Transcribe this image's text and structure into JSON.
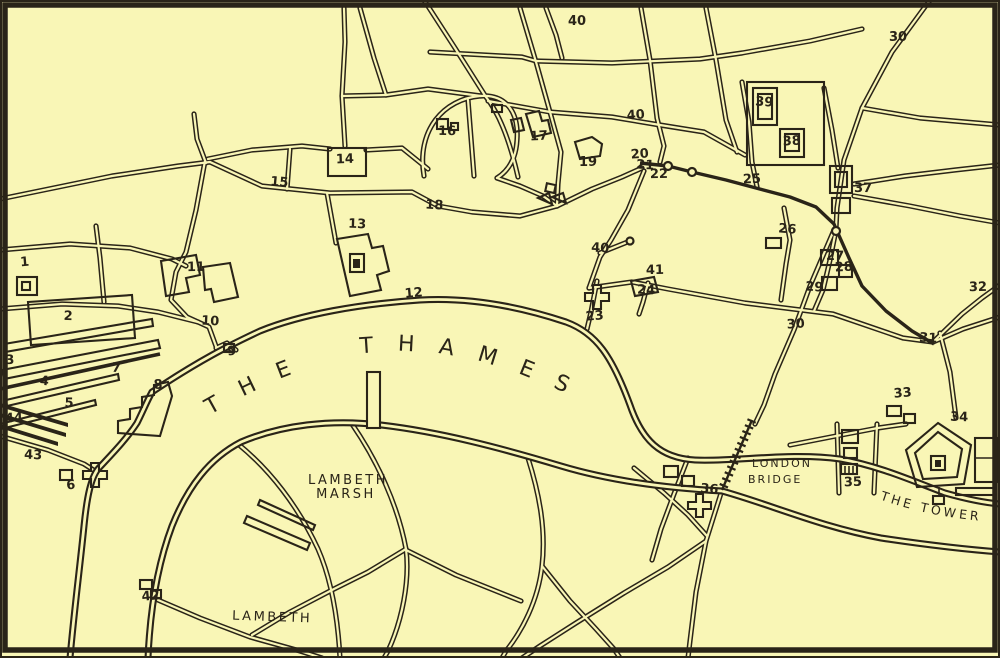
{
  "map": {
    "colors": {
      "paper": "#f9f6b6",
      "ink": "#2a2418"
    },
    "labels": {
      "thames": "THE THAMES",
      "lambeth_marsh_line1": "LAMBETH",
      "lambeth_marsh_line2": "MARSH",
      "lambeth": "LAMBETH",
      "london_bridge_line1": "LONDON",
      "london_bridge_line2": "BRIDGE",
      "the_tower": "THE TOWER"
    },
    "markers": [
      {
        "n": "1",
        "x": 25,
        "y": 266
      },
      {
        "n": "2",
        "x": 68,
        "y": 320
      },
      {
        "n": "3",
        "x": 10,
        "y": 364
      },
      {
        "n": "4",
        "x": 44,
        "y": 385
      },
      {
        "n": "5",
        "x": 69,
        "y": 407
      },
      {
        "n": "6",
        "x": 71,
        "y": 489
      },
      {
        "n": "7",
        "x": 116,
        "y": 372
      },
      {
        "n": "8",
        "x": 158,
        "y": 389
      },
      {
        "n": "9",
        "x": 232,
        "y": 355
      },
      {
        "n": "10",
        "x": 210,
        "y": 325
      },
      {
        "n": "11",
        "x": 196,
        "y": 271
      },
      {
        "n": "12",
        "x": 414,
        "y": 297
      },
      {
        "n": "13",
        "x": 357,
        "y": 228
      },
      {
        "n": "14",
        "x": 345,
        "y": 163
      },
      {
        "n": "15",
        "x": 279,
        "y": 186
      },
      {
        "n": "16",
        "x": 447,
        "y": 135
      },
      {
        "n": "17",
        "x": 539,
        "y": 140
      },
      {
        "n": "18",
        "x": 434,
        "y": 209
      },
      {
        "n": "19",
        "x": 588,
        "y": 166
      },
      {
        "n": "20",
        "x": 640,
        "y": 158
      },
      {
        "n": "21",
        "x": 645,
        "y": 169
      },
      {
        "n": "22",
        "x": 659,
        "y": 178
      },
      {
        "n": "23",
        "x": 595,
        "y": 320
      },
      {
        "n": "24",
        "x": 646,
        "y": 294
      },
      {
        "n": "25",
        "x": 752,
        "y": 183
      },
      {
        "n": "26",
        "x": 787,
        "y": 233
      },
      {
        "n": "27",
        "x": 835,
        "y": 260
      },
      {
        "n": "28",
        "x": 844,
        "y": 271
      },
      {
        "n": "29",
        "x": 814,
        "y": 291
      },
      {
        "n": "30",
        "x": 898,
        "y": 41
      },
      {
        "n": "30",
        "x": 796,
        "y": 328
      },
      {
        "n": "31",
        "x": 928,
        "y": 342
      },
      {
        "n": "32",
        "x": 978,
        "y": 291
      },
      {
        "n": "33",
        "x": 903,
        "y": 397
      },
      {
        "n": "34",
        "x": 959,
        "y": 421
      },
      {
        "n": "35",
        "x": 853,
        "y": 486
      },
      {
        "n": "36",
        "x": 709,
        "y": 493
      },
      {
        "n": "37",
        "x": 863,
        "y": 192
      },
      {
        "n": "38",
        "x": 792,
        "y": 145
      },
      {
        "n": "39",
        "x": 764,
        "y": 106
      },
      {
        "n": "40",
        "x": 577,
        "y": 25
      },
      {
        "n": "40",
        "x": 636,
        "y": 119
      },
      {
        "n": "40",
        "x": 600,
        "y": 252
      },
      {
        "n": "41",
        "x": 655,
        "y": 274
      },
      {
        "n": "42",
        "x": 151,
        "y": 600
      },
      {
        "n": "43",
        "x": 33,
        "y": 459
      },
      {
        "n": "44",
        "x": 14,
        "y": 422
      }
    ]
  }
}
